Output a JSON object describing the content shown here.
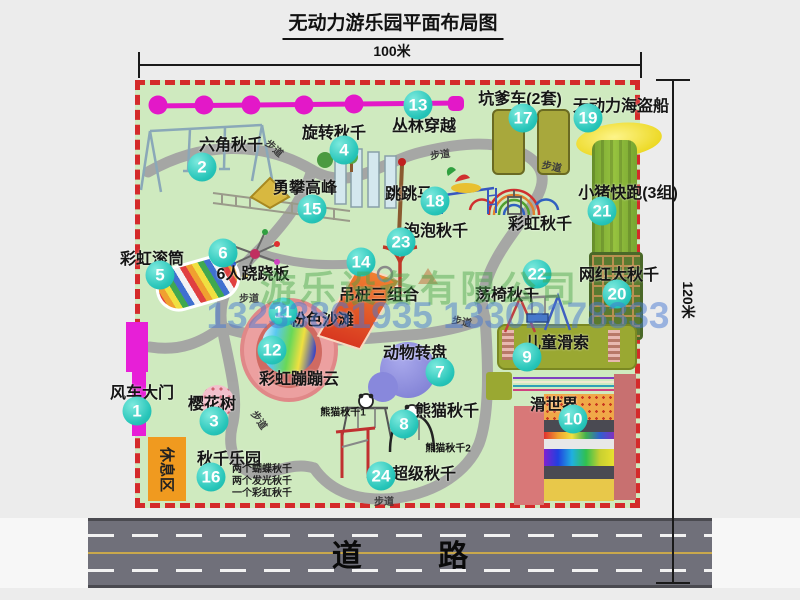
{
  "title": "无动力游乐园平面布局图",
  "dimensions": {
    "width": "100米",
    "height": "120米"
  },
  "road_label": "道 路",
  "watermark": {
    "company": "游乐设备有限公司",
    "phones": "13233861935 13302178333"
  },
  "rest_area_label": "休息区",
  "walkway_label": "步道",
  "extra_labels": {
    "rainbow_swing": "彩虹秋千",
    "panda1": "熊猫秋千1",
    "panda2": "熊猫秋千2"
  },
  "swing_park_notes": [
    "两个蝴蝶秋千",
    "两个发光秋千",
    "一个彩虹秋千"
  ],
  "attractions": [
    {
      "num": "1",
      "name": "风车大门"
    },
    {
      "num": "2",
      "name": "六角秋千"
    },
    {
      "num": "3",
      "name": "樱花树"
    },
    {
      "num": "4",
      "name": "旋转秋千"
    },
    {
      "num": "5",
      "name": "彩虹滚筒"
    },
    {
      "num": "6",
      "name": "6人跷跷板"
    },
    {
      "num": "7",
      "name": "动物转盘"
    },
    {
      "num": "8",
      "name": "熊猫秋千"
    },
    {
      "num": "9",
      "name": "儿童滑索"
    },
    {
      "num": "10",
      "name": "滑世界"
    },
    {
      "num": "11",
      "name": "粉色沙滩"
    },
    {
      "num": "12",
      "name": "彩虹蹦蹦云"
    },
    {
      "num": "13",
      "name": "丛林穿越"
    },
    {
      "num": "14",
      "name": "吊桩三组合"
    },
    {
      "num": "15",
      "name": "勇攀高峰"
    },
    {
      "num": "16",
      "name": "秋千乐园"
    },
    {
      "num": "17",
      "name": "坑爹车(2套)"
    },
    {
      "num": "18",
      "name": "跳跳马"
    },
    {
      "num": "19",
      "name": "无动力海盗船"
    },
    {
      "num": "20",
      "name": "网红大秋千"
    },
    {
      "num": "21",
      "name": "小猪快跑(3组)"
    },
    {
      "num": "22",
      "name": "荡椅秋千"
    },
    {
      "num": "23",
      "name": "泡泡秋千"
    },
    {
      "num": "24",
      "name": "超级秋千"
    }
  ],
  "colors": {
    "map_background": "#cfeabf",
    "border_dashed_red": "#d42a2a",
    "badge_teal": "#27c5b9",
    "zipline_magenta": "#e318c8",
    "gate_magenta": "#e71fd7",
    "rest_area_orange": "#f09a1f",
    "road_gray": "#70707a"
  }
}
